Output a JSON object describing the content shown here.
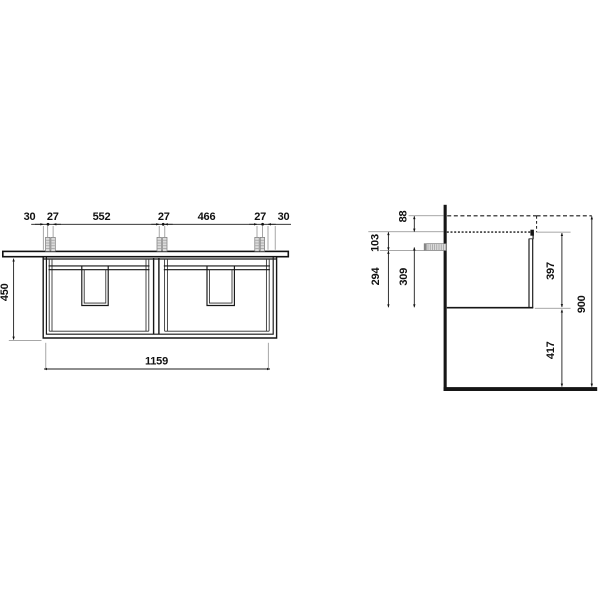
{
  "drawing": {
    "front_view": {
      "top_dims": [
        "30",
        "27",
        "552",
        "27",
        "466",
        "27",
        "30"
      ],
      "height_dim": "450",
      "width_dim": "1159"
    },
    "side_view": {
      "dims": [
        "88",
        "103",
        "294",
        "309",
        "397",
        "417",
        "900"
      ]
    }
  }
}
